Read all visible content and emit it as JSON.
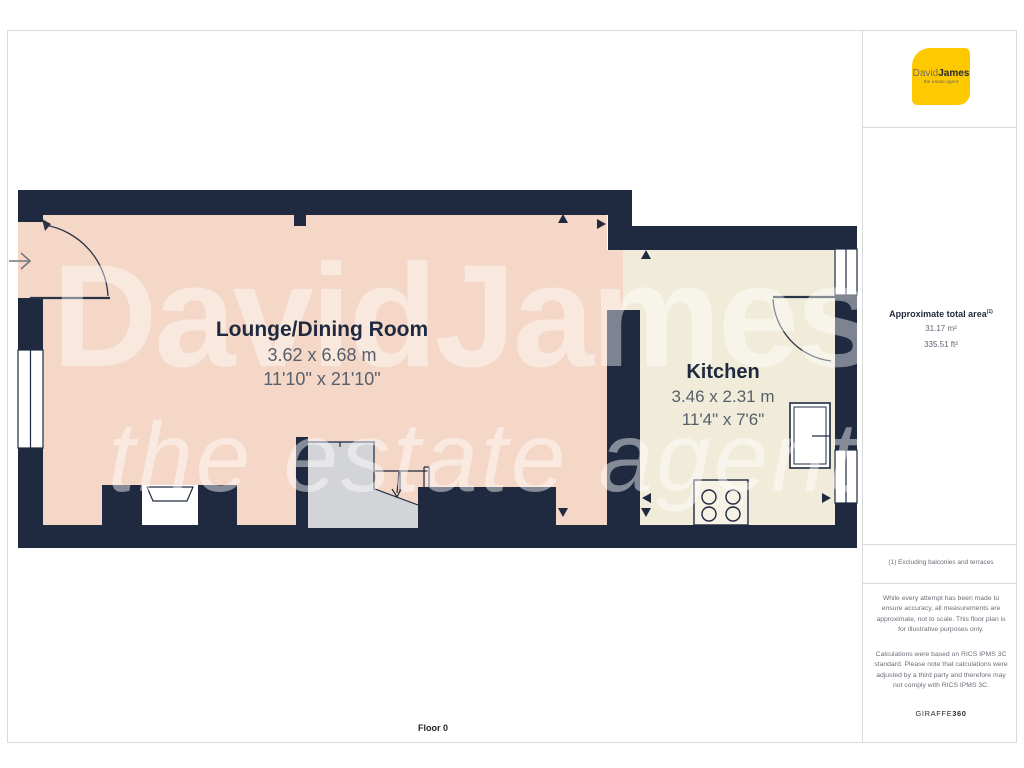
{
  "plan": {
    "floor_label": "Floor 0",
    "watermark": {
      "line1": "DavidJames",
      "line2": "the estate agent"
    },
    "rooms": [
      {
        "name": "Lounge/Dining Room",
        "metric": "3.62 x 6.68 m",
        "imperial": "11'10\" x 21'10\""
      },
      {
        "name": "Kitchen",
        "metric": "3.46 x 2.31 m",
        "imperial": "11'4\" x 7'6\""
      }
    ],
    "symbols": [
      "entry-arrow",
      "door-arc-front",
      "door-arc-kitchen",
      "window-left",
      "window-kitchen",
      "stairs",
      "hob",
      "fridge-unit",
      "fireplace"
    ]
  },
  "sidebar": {
    "logo": {
      "brand_primary": "David",
      "brand_secondary": "James",
      "tagline": "the estate agent"
    },
    "area": {
      "title": "Approximate total area",
      "title_superscript": "(1)",
      "metric": "31.17 m²",
      "imperial": "335.51 ft²"
    },
    "footnote": "(1) Excluding balconies and terraces",
    "disclaimer_1": "While every attempt has been made to ensure accuracy, all measurements are approximate, not to scale. This floor plan is for illustrative purposes only.",
    "disclaimer_2": "Calculations were based on RICS IPMS 3C standard. Please note that calculations were adjusted by a third party and therefore may not comply with RICS IPMS 3C.",
    "brand_footer_name": "GIRAFFE",
    "brand_footer_number": "360"
  },
  "colors": {
    "wall": "#1f2a40",
    "lounge_fill": "#f4d7c7",
    "kitchen_fill": "#f1ecda",
    "stairs_fill": "#d3d4d8",
    "logo_yellow": "#fec901",
    "dim_text": "#565f6d",
    "divider_gray": "#d9dadd"
  }
}
